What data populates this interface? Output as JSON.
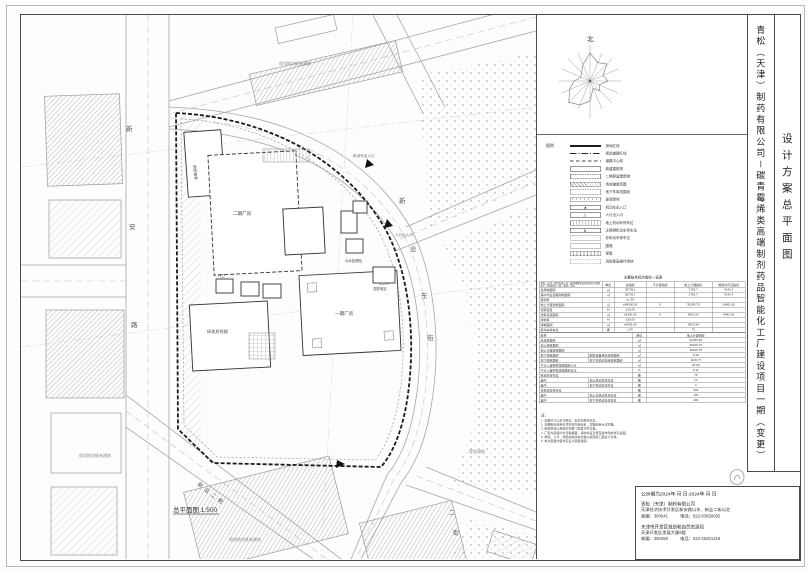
{
  "sheet": {
    "north_label": "北"
  },
  "title_block": {
    "project_name": "青松（天津）制药有限公司－碳青霉烯类高端制剂药品智能化工厂建设项目一期（变更）",
    "drawing_title": "设计方案总平面图"
  },
  "legend": {
    "header": "图例",
    "items": [
      {
        "style": "solidthick",
        "label": "用地红线"
      },
      {
        "style": "dashdot",
        "label": "规划道路红线"
      },
      {
        "style": "dashed",
        "label": "道路中心线"
      },
      {
        "style": "rect",
        "label": "新建建筑物"
      },
      {
        "style": "rectbold",
        "label": "二期预留建筑物"
      },
      {
        "style": "recthatch",
        "label": "场地铺装范围"
      },
      {
        "style": "rectdash",
        "label": "地下车库范围线"
      },
      {
        "style": "rectdots",
        "label": "景观绿地"
      },
      {
        "style": "recttri",
        "label": "机动车出入口"
      },
      {
        "style": "recttri2",
        "label": "人行出入口"
      },
      {
        "style": "rectcomb",
        "label": "地上机动车停车位"
      },
      {
        "style": "rectacc",
        "label": "无障碍机动车停车位"
      },
      {
        "style": "rectdots2",
        "label": "非机动车停车位"
      },
      {
        "style": "rectthin",
        "label": "围墙"
      },
      {
        "style": "recthedge",
        "label": "绿篱"
      },
      {
        "style": "rectdash2",
        "label": "消防登高操作场地"
      }
    ]
  },
  "table": {
    "title": "主要技术经济指标一览表",
    "top": {
      "columns": [
        "青松（天津）制药有限公司－碳青霉烯类高端制剂药品智能化工厂建设项目一期（变更）指标",
        "单位",
        "总指标",
        "不计容指标",
        "地上计容指标",
        "规划许可证指标"
      ],
      "rows": [
        [
          "总用地面积",
          "㎡",
          "35739.1",
          "",
          "2781.7",
          "4141.4"
        ],
        [
          "其中代征道路用地面积",
          "㎡",
          "35739.1",
          "",
          "2781.7",
          "4141.4"
        ],
        [
          "容积率",
          "—",
          "≤1.35",
          "",
          "",
          ""
        ],
        [
          "地上计容建筑面积",
          "㎡",
          "≤48000.00",
          "0",
          "30299.75",
          "24602.00"
        ],
        [
          "建筑密度",
          "%",
          "≥16.00",
          "",
          "",
          ""
        ],
        [
          "建筑基底面积",
          "㎡",
          "≥5340.00",
          "0",
          "8462.53",
          "8462.00"
        ],
        [
          "绿地率",
          "%",
          "≤30.00",
          "",
          "",
          ""
        ],
        [
          "绿地面积",
          "㎡",
          "≤4536.00",
          "",
          "4536.94",
          ""
        ],
        [
          "机动车停车位",
          "辆",
          "≥75",
          "",
          "75",
          ""
        ]
      ]
    },
    "bottom": {
      "columns": [
        "名称",
        "",
        "单位",
        "地上计容指标"
      ],
      "rows": [
        [
          "总建筑面积",
          "",
          "㎡",
          "31250.46"
        ],
        [
          "地上建筑面积",
          "",
          "㎡",
          "30106.76"
        ],
        [
          "地上计容建筑面积",
          "",
          "㎡",
          "30106.76"
        ],
        [
          "地下建筑面积",
          "配套设备用房建筑面积",
          "㎡",
          "6.48"
        ],
        [
          "地下建筑面积",
          "地下非机动车库建筑面积",
          "㎡",
          "1135.77"
        ],
        [
          "不计入容积率建筑面积小计",
          "",
          "㎡",
          "36.00"
        ],
        [
          "不计入容积率建筑面积占比",
          "",
          "%",
          "0.12"
        ],
        [
          "机动车停车位",
          "",
          "辆",
          "75"
        ],
        [
          "其中",
          "地上机动车停车位",
          "辆",
          "72"
        ],
        [
          "其中",
          "地下机动车停车位",
          "辆",
          "3"
        ],
        [
          "非机动车停车位",
          "",
          "辆",
          "300"
        ],
        [
          "其中",
          "地上非机动车停车位",
          "辆",
          "100"
        ],
        [
          "其中",
          "地下非机动车停车位",
          "辆",
          "200"
        ]
      ]
    }
  },
  "notes": {
    "header": "注：",
    "items": [
      "1. 本图尺寸以米为单位，标高为绝对标高。",
      "2. 本图坐标采用天津市地方坐标系，高程采用大沽高程。",
      "3. 用地界线以规划主管部门核发文件为准。",
      "4. 厂区内道路均为沥青路面，消防车道及登高操作场地详见总图。",
      "5. 绿化、人行、非机动车停车位等以最终施工图设计为准。",
      "6. 本次变更内容详见设计变更说明。"
    ]
  },
  "footer": {
    "publicity": "公示期为2024年  月  日-2024年  月  日",
    "company": {
      "name": "青松（天津）制药有限公司",
      "address": "天津经济技术开发区新安路以东、新业二街以北",
      "postal": "邮编：300041",
      "phone": "电话：022-63650002"
    },
    "bureau": {
      "name": "天津市开发区规划和自然资源局",
      "address": "天津开发区发展大厦6楼",
      "postal": "邮编：300450",
      "phone": "电话：022-25201316"
    }
  },
  "plan": {
    "scale_label": "总平面图 1:500",
    "road_chars": {
      "west": [
        "新",
        "安",
        "路"
      ],
      "east": [
        "新",
        "业",
        "东",
        "街"
      ],
      "south": [
        "二",
        "街"
      ]
    },
    "road_names": {
      "southwest": "新业二街"
    },
    "buildings": {
      "phase2_plant": "二期厂房",
      "phase1_plant": "一期厂房",
      "rd_building": "研发质检楼",
      "dorm": "倒班宿舍",
      "sewage": "污水处理站",
      "substation": "变配电站",
      "gatehouse": "门卫"
    },
    "annotations": {
      "vehicle_entrance": "机动车出入口",
      "pedestrian_entrance": "人行出入口",
      "adjacent": "相邻地块既有建筑",
      "green": "规划绿地"
    }
  }
}
